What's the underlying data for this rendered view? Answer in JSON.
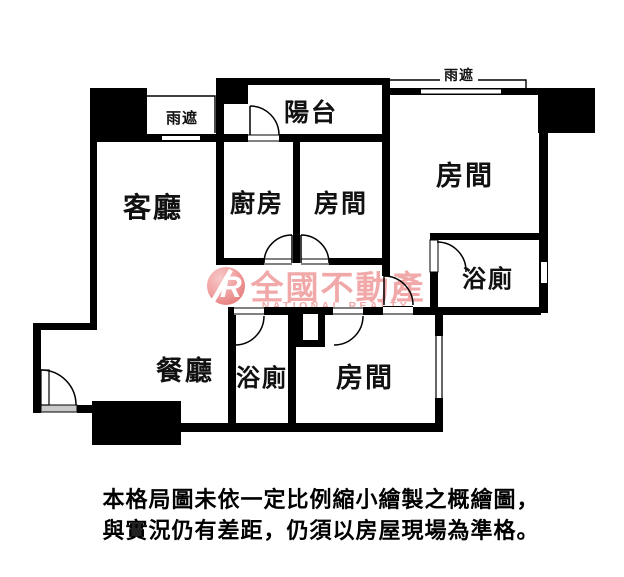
{
  "plan": {
    "labels": {
      "living": "客廳",
      "kitchen": "廚房",
      "dining": "餐廳",
      "balcony": "陽台",
      "bedroom_mid": "房間",
      "bedroom_right": "房間",
      "bedroom_bottom": "房間",
      "bath_right": "浴廁",
      "bath_bottom": "浴廁",
      "canopy_left": "雨遮",
      "canopy_right": "雨遮"
    }
  },
  "watermark": {
    "logo_letter": "R",
    "brand": "全國不動產",
    "brand_en": "NATIONAL REALTY"
  },
  "disclaimer": {
    "line1": "本格局圖未依一定比例縮小繪製之概繪圖，",
    "line2": "與實況仍有差距，仍須以房屋現場為準格。"
  },
  "colors": {
    "wall": "#000000",
    "background": "#ffffff",
    "watermark": "#ef9a9a",
    "threshold_gray": "#c9c9c9"
  }
}
